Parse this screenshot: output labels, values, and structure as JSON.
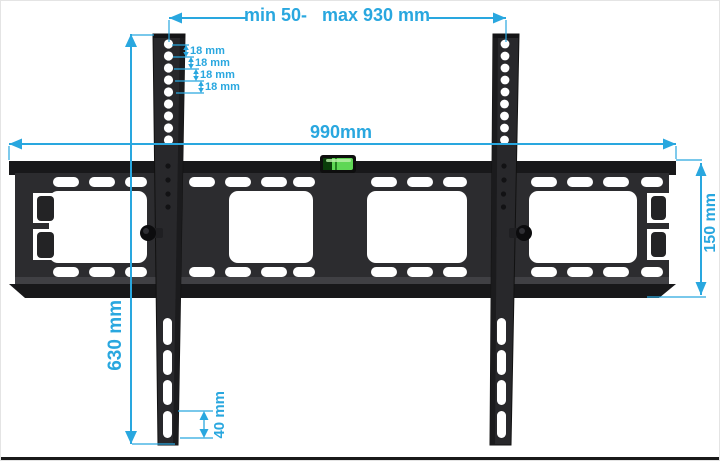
{
  "figure": {
    "kind": "tv-wall-mount-dimension-diagram"
  },
  "colors": {
    "dimension_blue": "#29a7df",
    "bracket_body": "#2c2c2f",
    "bracket_flange": "#18181a",
    "level_green": "#5fd755"
  },
  "dimensions": {
    "mount_span": {
      "min_label": "min 50-",
      "max_label": "max 930 mm"
    },
    "plate_width": "990mm",
    "rail_height": "630 mm",
    "plate_height": "150 mm",
    "slot_height": "40 mm",
    "hole_spacing": [
      {
        "label": "18 mm"
      },
      {
        "label": "18 mm"
      },
      {
        "label": "18 mm"
      },
      {
        "label": "18 mm"
      }
    ]
  }
}
